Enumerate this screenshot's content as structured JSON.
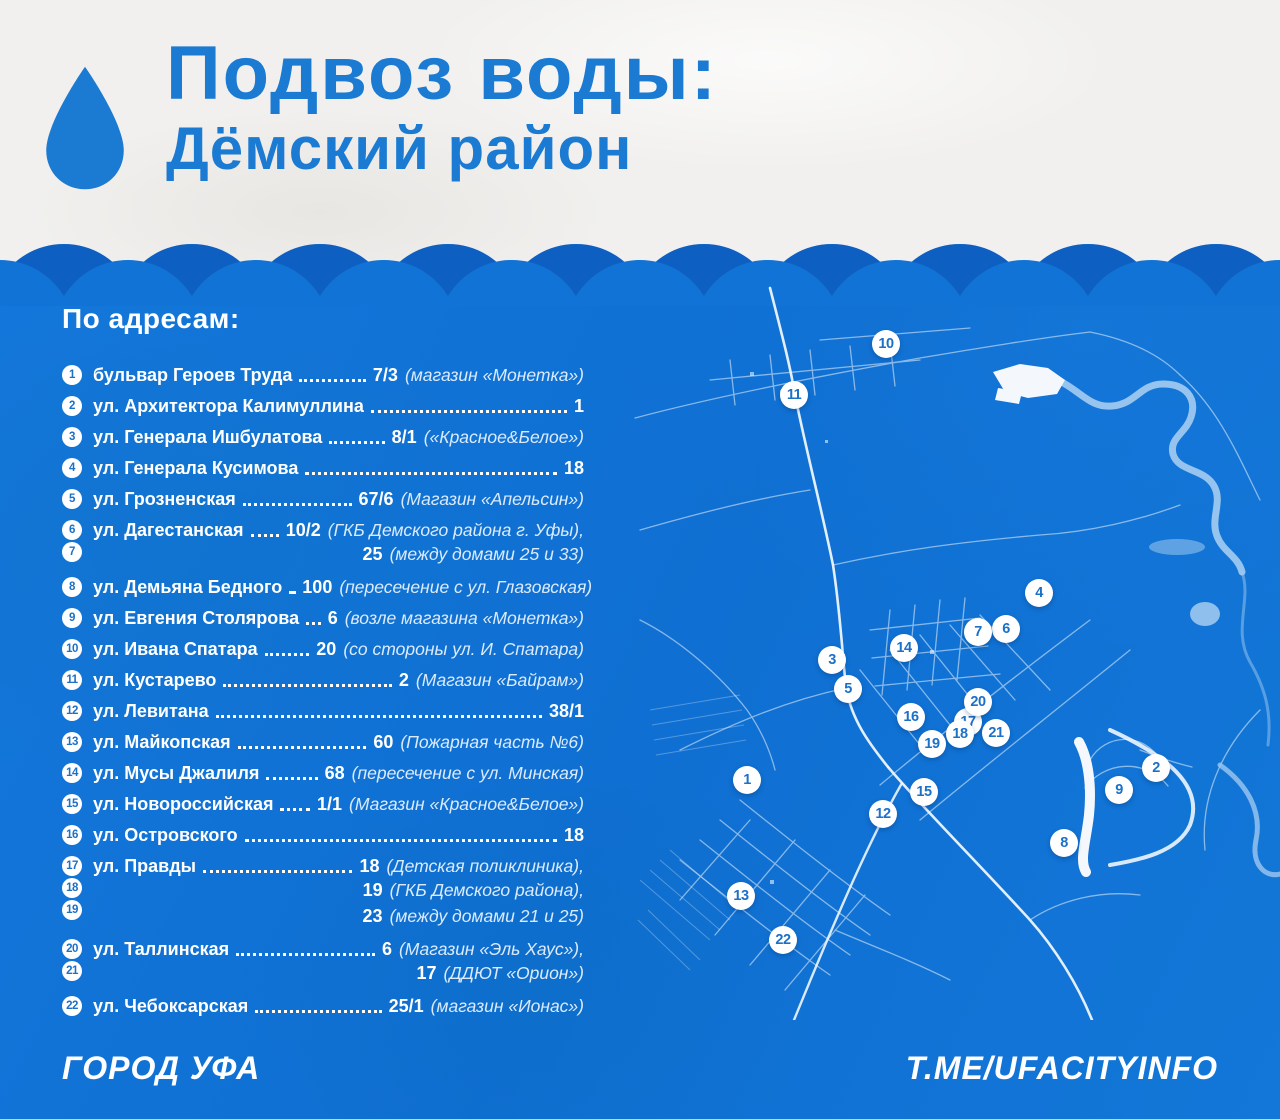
{
  "header": {
    "title": "Подвоз воды:",
    "subtitle": "Дёмский район"
  },
  "list": {
    "heading": "По адресам:",
    "items": [
      {
        "badges": [
          "1"
        ],
        "street": "бульвар Героев Труда",
        "value": "7/3",
        "note": "(магазин «Монетка»)",
        "extra": []
      },
      {
        "badges": [
          "2"
        ],
        "street": "ул. Архитектора Калимуллина",
        "value": "1",
        "note": "",
        "extra": []
      },
      {
        "badges": [
          "3"
        ],
        "street": "ул. Генерала Ишбулатова",
        "value": "8/1",
        "note": "(«Красное&Белое»)",
        "extra": []
      },
      {
        "badges": [
          "4"
        ],
        "street": "ул. Генерала Кусимова",
        "value": "18",
        "note": "",
        "extra": []
      },
      {
        "badges": [
          "5"
        ],
        "street": "ул. Грозненская",
        "value": "67/6",
        "note": "(Магазин «Апельсин»)",
        "extra": []
      },
      {
        "badges": [
          "6",
          "7"
        ],
        "street": "ул. Дагестанская",
        "value": "10/2",
        "note": "(ГКБ Демского района г. Уфы),",
        "extra": [
          {
            "value": "25",
            "note": "(между домами 25 и 33)"
          }
        ]
      },
      {
        "badges": [
          "8"
        ],
        "street": "ул. Демьяна Бедного",
        "value": "100",
        "note": "(пересечение с ул. Глазовская)",
        "extra": []
      },
      {
        "badges": [
          "9"
        ],
        "street": "ул. Евгения Столярова",
        "value": "6",
        "note": "(возле магазина «Монетка»)",
        "extra": []
      },
      {
        "badges": [
          "10"
        ],
        "street": "ул. Ивана Спатара",
        "value": "20",
        "note": "(со стороны ул. И. Спатара)",
        "extra": []
      },
      {
        "badges": [
          "11"
        ],
        "street": "ул. Кустарево",
        "value": "2",
        "note": "(Магазин «Байрам»)",
        "extra": []
      },
      {
        "badges": [
          "12"
        ],
        "street": "ул. Левитана",
        "value": "38/1",
        "note": "",
        "extra": []
      },
      {
        "badges": [
          "13"
        ],
        "street": "ул. Майкопская",
        "value": "60",
        "note": "(Пожарная часть №6)",
        "extra": []
      },
      {
        "badges": [
          "14"
        ],
        "street": "ул. Мусы Джалиля",
        "value": "68",
        "note": "(пересечение с ул. Минская)",
        "extra": []
      },
      {
        "badges": [
          "15"
        ],
        "street": "ул. Новороссийская",
        "value": "1/1",
        "note": "(Магазин «Красное&Белое»)",
        "extra": []
      },
      {
        "badges": [
          "16"
        ],
        "street": "ул. Островского",
        "value": "18",
        "note": "",
        "extra": []
      },
      {
        "badges": [
          "17",
          "18",
          "19"
        ],
        "street": "ул. Правды",
        "value": "18",
        "note": "(Детская поликлиника),",
        "extra": [
          {
            "value": "19",
            "note": "(ГКБ Демского района),"
          },
          {
            "value": "23",
            "note": "(между домами 21 и 25)"
          }
        ]
      },
      {
        "badges": [
          "20",
          "21"
        ],
        "street": "ул. Таллинская",
        "value": "6",
        "note": "(Магазин «Эль Хаус»),",
        "extra": [
          {
            "value": "17",
            "note": "(ДДЮТ «Орион»)"
          }
        ]
      },
      {
        "badges": [
          "22"
        ],
        "street": "ул. Чебоксарская",
        "value": "25/1",
        "note": "(магазин «Ионас»)",
        "extra": []
      }
    ]
  },
  "map": {
    "markers": [
      {
        "n": "1",
        "x": 127,
        "y": 500
      },
      {
        "n": "2",
        "x": 536,
        "y": 488
      },
      {
        "n": "3",
        "x": 212,
        "y": 380
      },
      {
        "n": "4",
        "x": 419,
        "y": 313
      },
      {
        "n": "5",
        "x": 228,
        "y": 409
      },
      {
        "n": "6",
        "x": 386,
        "y": 349
      },
      {
        "n": "7",
        "x": 358,
        "y": 352
      },
      {
        "n": "8",
        "x": 444,
        "y": 563
      },
      {
        "n": "9",
        "x": 499,
        "y": 510
      },
      {
        "n": "10",
        "x": 266,
        "y": 64
      },
      {
        "n": "11",
        "x": 174,
        "y": 115
      },
      {
        "n": "12",
        "x": 263,
        "y": 534
      },
      {
        "n": "13",
        "x": 121,
        "y": 616
      },
      {
        "n": "14",
        "x": 284,
        "y": 368
      },
      {
        "n": "15",
        "x": 304,
        "y": 512
      },
      {
        "n": "16",
        "x": 291,
        "y": 437
      },
      {
        "n": "17",
        "x": 348,
        "y": 442
      },
      {
        "n": "18",
        "x": 340,
        "y": 454
      },
      {
        "n": "19",
        "x": 312,
        "y": 464
      },
      {
        "n": "20",
        "x": 358,
        "y": 422
      },
      {
        "n": "21",
        "x": 376,
        "y": 453
      },
      {
        "n": "22",
        "x": 163,
        "y": 660
      }
    ]
  },
  "footer": {
    "left": "ГОРОД УФА",
    "right": "T.ME/UFACITYINFO"
  },
  "colors": {
    "background_blue": "#1173d6",
    "wave_dark_blue": "#0d5fc2",
    "title_blue": "#1b7ad2",
    "header_bg": "#f1f0ee",
    "note_text": "#dcebfb",
    "badge_text": "#1b70c8"
  }
}
